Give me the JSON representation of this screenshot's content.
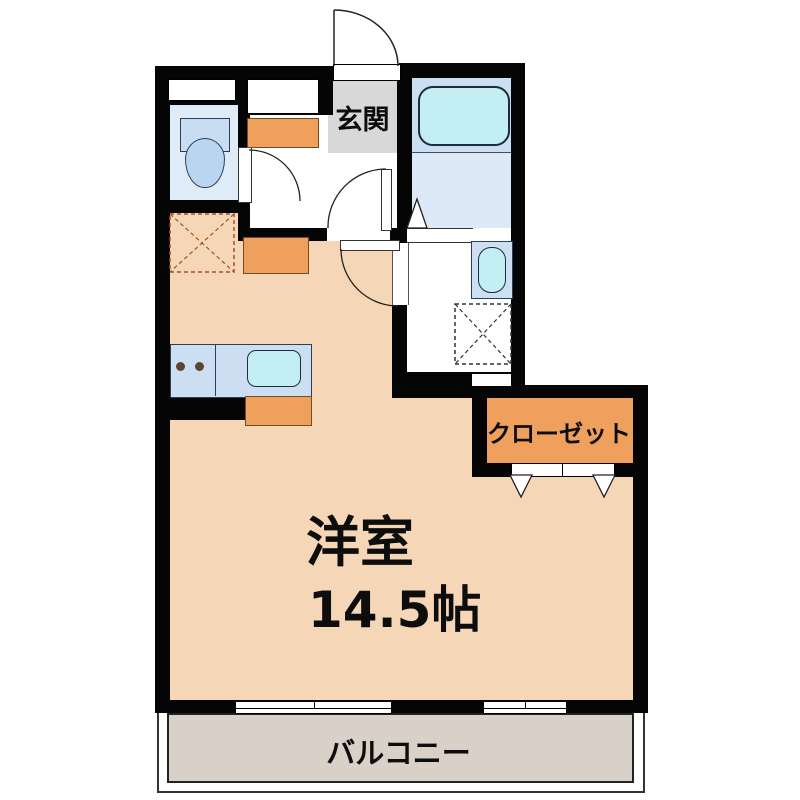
{
  "plan": {
    "rooms": {
      "genkan": {
        "label": "玄関"
      },
      "main_room": {
        "label": "洋室",
        "size": "14.5帖"
      },
      "closet": {
        "label": "クローゼット"
      },
      "balcony": {
        "label": "バルコニー"
      }
    },
    "colors": {
      "wall": "#050505",
      "main_room_floor": "#f5d6b6",
      "balcony_floor": "#d9d0c8",
      "genkan_floor": "#d8d8d8",
      "bath_upper_floor": "#cbdff2",
      "wet_area_floor": "#dde9f7",
      "toilet_floor": "#e0ebf8",
      "fixture_blue": "#c8dcf2",
      "fixture_cyan": "#c3eef4",
      "cabinet_orange": "#efa05c"
    },
    "fixtures": [
      "toilet",
      "bathtub",
      "washbasin",
      "washing-machine-space",
      "refrigerator-space",
      "kitchen-counter",
      "kitchen-sink",
      "shoe-cabinet"
    ]
  }
}
